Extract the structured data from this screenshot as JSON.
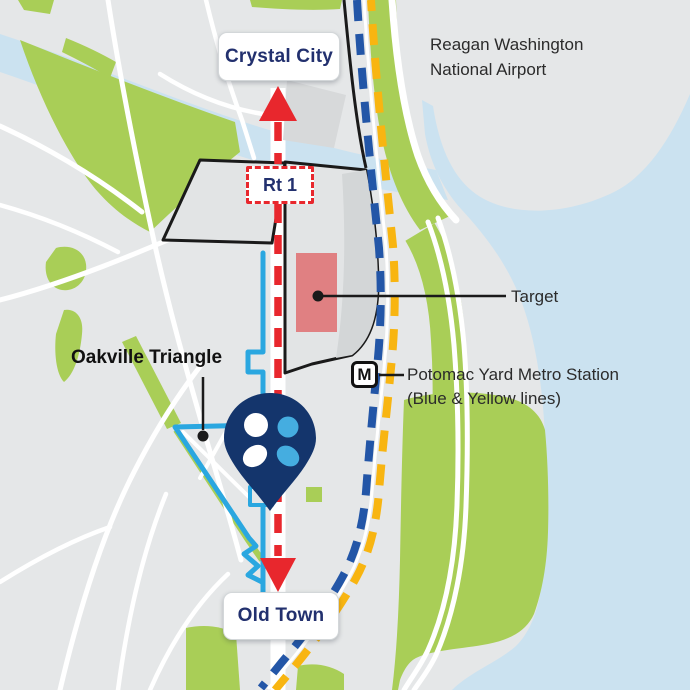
{
  "labels": {
    "crystal_city": "Crystal City",
    "airport": "Reagan Washington National Airport",
    "route_shield": "Rt 1",
    "target": "Target",
    "oakville_triangle": "Oakville Triangle",
    "metro_icon_letter": "M",
    "metro_station_name": "Potomac Yard Metro Station",
    "metro_station_lines": "(Blue & Yellow lines)",
    "old_town": "Old Town"
  },
  "colors": {
    "background_land": "#E5E7E8",
    "water": "#CBE2F0",
    "park_green": "#A9CE57",
    "road_white": "#FFFFFF",
    "route1_red": "#E8272D",
    "metro_blue": "#2356A7",
    "metro_yellow": "#F8B511",
    "site_boundary_cyan": "#2AA7E0",
    "target_building_pink": "#E08082",
    "pin_navy": "#14356C",
    "logo_light_blue": "#45ADE0",
    "label_navy": "#22306E",
    "map_text_black": "#2B2B2B",
    "parcel_outline_black": "#1A1A1A"
  }
}
